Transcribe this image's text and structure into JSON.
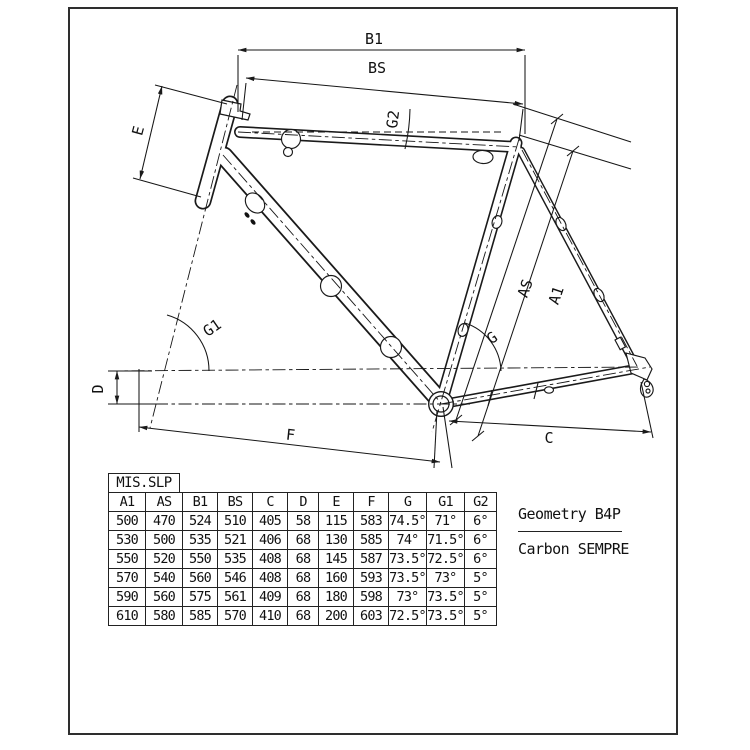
{
  "drawing": {
    "labels": {
      "b1": "B1",
      "bs": "BS",
      "g2": "G2",
      "e": "E",
      "as": "AS",
      "a1": "A1",
      "g": "G",
      "g1": "G1",
      "d": "D",
      "f": "F",
      "c": "C"
    }
  },
  "table": {
    "tab": "MIS.SLP",
    "columns": [
      "A1",
      "AS",
      "B1",
      "BS",
      "C",
      "D",
      "E",
      "F",
      "G",
      "G1",
      "G2"
    ],
    "rows": [
      [
        "500",
        "470",
        "524",
        "510",
        "405",
        "58",
        "115",
        "583",
        "74.5°",
        "71°",
        "6°"
      ],
      [
        "530",
        "500",
        "535",
        "521",
        "406",
        "68",
        "130",
        "585",
        "74°",
        "71.5°",
        "6°"
      ],
      [
        "550",
        "520",
        "550",
        "535",
        "408",
        "68",
        "145",
        "587",
        "73.5°",
        "72.5°",
        "6°"
      ],
      [
        "570",
        "540",
        "560",
        "546",
        "408",
        "68",
        "160",
        "593",
        "73.5°",
        "73°",
        "5°"
      ],
      [
        "590",
        "560",
        "575",
        "561",
        "409",
        "68",
        "180",
        "598",
        "73°",
        "73.5°",
        "5°"
      ],
      [
        "610",
        "580",
        "585",
        "570",
        "410",
        "68",
        "200",
        "603",
        "72.5°",
        "73.5°",
        "5°"
      ]
    ]
  },
  "annotation": {
    "line1": "Geometry B4P",
    "line2": "Carbon SEMPRE"
  }
}
